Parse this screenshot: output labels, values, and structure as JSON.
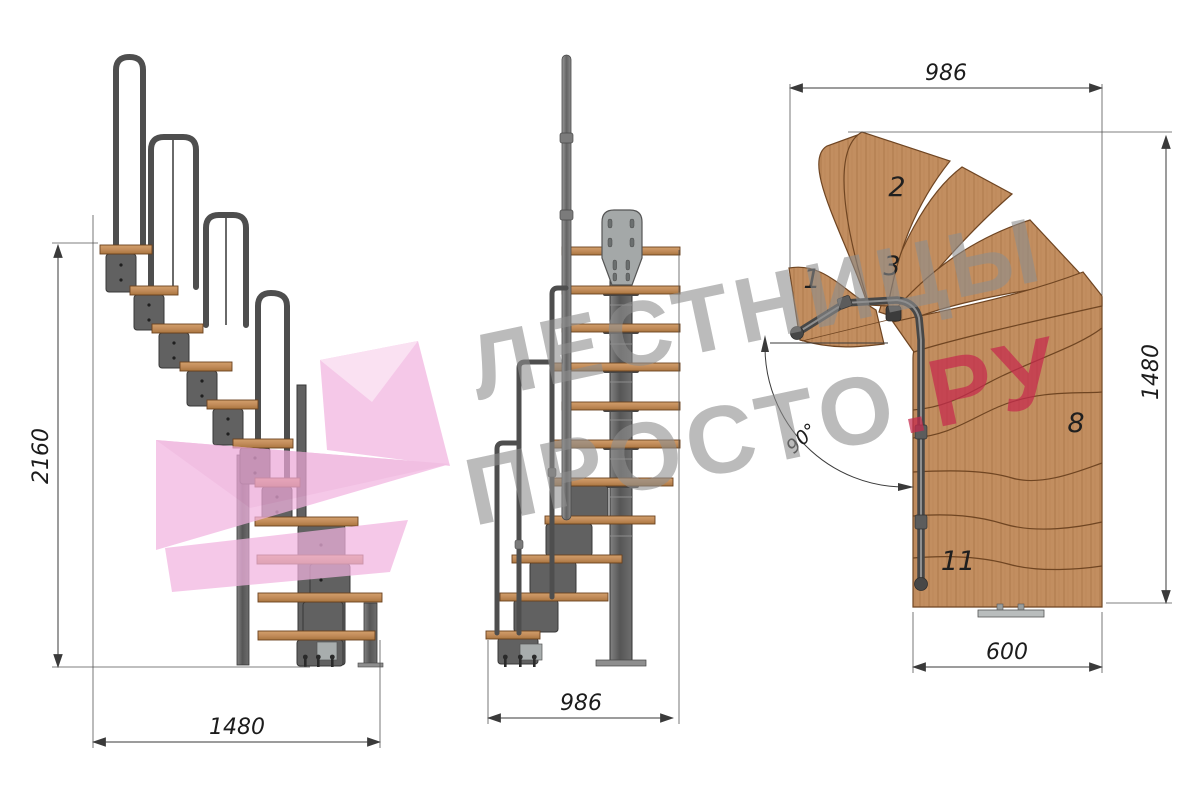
{
  "watermark": {
    "line1": "ЛЕСТНИЦЫ",
    "line2_gray": "ПРОСТО",
    "line2_red": ".РУ",
    "gray_color": "#8e8e8e",
    "red_color": "#c72a4d",
    "pink_color": "#f2b3e0"
  },
  "side_view": {
    "height_mm": "2160",
    "run_mm": "1480"
  },
  "front_view": {
    "width_mm": "986"
  },
  "plan_view": {
    "top_mm": "986",
    "right_mm": "1480",
    "bottom_mm": "600",
    "angle": "90°",
    "tread_numbers": {
      "t1": "1",
      "t2": "2",
      "t3": "3",
      "t8": "8",
      "t11": "11"
    }
  },
  "colors": {
    "wood": "#c28e60",
    "wood_edge": "#7d5128",
    "metal": "#5a5a5a",
    "metal_dark": "#3c3c3c",
    "plate": "#a8adad",
    "dimension": "#3a3a3a"
  }
}
